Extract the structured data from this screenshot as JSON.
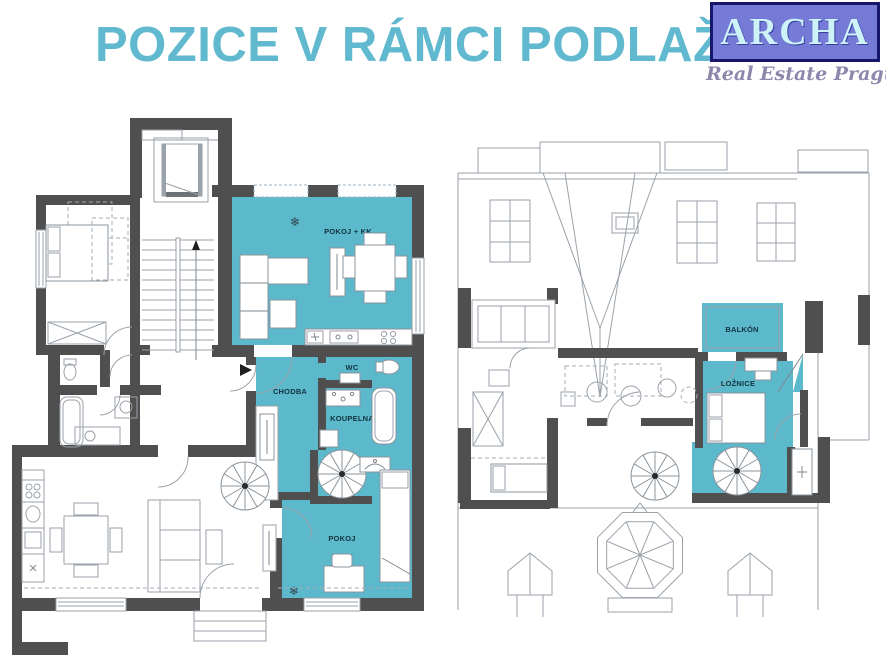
{
  "header": {
    "title": "POZICE V RÁMCI PODLAŽÍ"
  },
  "logo": {
    "name": "ARCHA",
    "tagline": "Real Estate Prague"
  },
  "colors": {
    "highlight": "#5cb9cb",
    "wall": "#4f4f4f",
    "title_text": "#60b9cf",
    "logo_background": "#747ad6",
    "logo_border": "#16166a",
    "logo_text": "#cdf2f8",
    "tagline_text": "#8e87ac",
    "line_light": "#9aa2aa",
    "label_text": "#12333f"
  },
  "icons": {
    "snowflake": "❄"
  },
  "floorplan_left": {
    "rooms": [
      {
        "label": "POKOJ + KK"
      },
      {
        "label": "CHODBA"
      },
      {
        "label": "WC"
      },
      {
        "label": "KOUPELNA"
      },
      {
        "label": "POKOJ"
      }
    ]
  },
  "floorplan_right": {
    "rooms": [
      {
        "label": "BALKÓN"
      },
      {
        "label": "LOŽNICE"
      }
    ]
  }
}
